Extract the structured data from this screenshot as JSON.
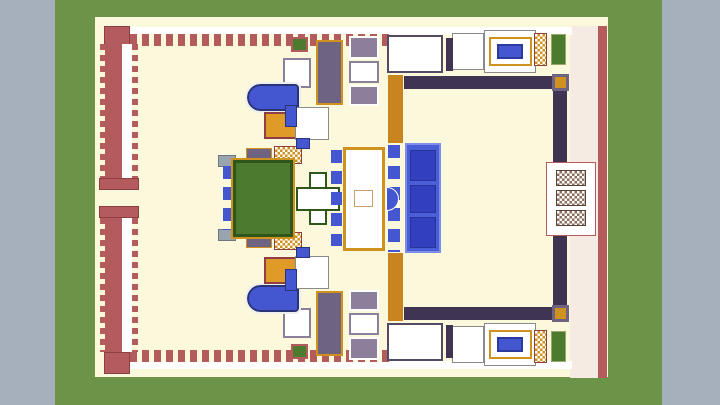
{
  "viewer": {
    "type": "3d-model-top-view",
    "subject": "minecraft-palace-build"
  },
  "palette": {
    "viewer_gray": "#a6b0bc",
    "grass_green": "#6b9448",
    "sand_cream": "#fbf8dc",
    "wall_red": "#b35b5d",
    "wall_dark_red": "#8e3f43",
    "gold": "#d0921e",
    "gold_light": "#ffd76e",
    "royal_blue": "#4456d0",
    "carpet_blue": "#4a5ed8",
    "carpet_panel_blue": "#3240c0",
    "purple_light": "#8b7f9b",
    "purple_dark": "#6e6380",
    "garden_green": "#4c7a2e",
    "garden_dark_green": "#2f571c",
    "tan": "#c9a06a",
    "navy": "#2b3a8c"
  },
  "scene": {
    "width": 720,
    "height": 405,
    "mirror_axis": 198,
    "blocks": [
      {
        "name": "viewer-background",
        "x": 0,
        "y": 0,
        "w": 720,
        "h": 405,
        "bg": "#a6b0bc"
      },
      {
        "name": "grass-ground",
        "x": 55,
        "y": 0,
        "w": 607,
        "h": 405,
        "bg": "#6b9448"
      },
      {
        "name": "sand-courtyard",
        "x": 95,
        "y": 17,
        "w": 513,
        "h": 360,
        "bg": "#fbf8dc"
      },
      {
        "name": "north-wall-checker-band",
        "x": 130,
        "y": 27,
        "w": 262,
        "h": 7,
        "bg": "#ffffff",
        "pattern": "checker",
        "c1": "#15151a",
        "c2": "#ffffff",
        "cs": "3px",
        "mirror": true
      },
      {
        "name": "north-wall-merlons",
        "x": 130,
        "y": 34,
        "w": 262,
        "h": 12,
        "pattern": "dash-h",
        "c1": "#b35b5d",
        "mirror": true
      },
      {
        "name": "northwest-corner-tower",
        "x": 104,
        "y": 26,
        "w": 26,
        "h": 22,
        "bg": "#b35b5d",
        "bc": "#8e3f43",
        "bw": 1
      },
      {
        "name": "southwest-corner-tower",
        "x": 104,
        "y": 352,
        "w": 26,
        "h": 22,
        "bg": "#b35b5d",
        "bc": "#8e3f43",
        "bw": 1
      },
      {
        "name": "west-wall-teeth-upper",
        "x": 100,
        "y": 44,
        "w": 5,
        "h": 134,
        "pattern": "dash-v",
        "c1": "#b35b5d"
      },
      {
        "name": "west-wall-upper",
        "x": 105,
        "y": 44,
        "w": 17,
        "h": 134,
        "bg": "#b35b5d"
      },
      {
        "name": "west-walkway-upper",
        "x": 122,
        "y": 44,
        "w": 10,
        "h": 134,
        "bg": "#ffffff"
      },
      {
        "name": "west-wall-dashes-upper",
        "x": 132,
        "y": 44,
        "w": 6,
        "h": 134,
        "pattern": "dash-v",
        "c1": "#b35b5d"
      },
      {
        "name": "west-gate-north-cap",
        "x": 99,
        "y": 178,
        "w": 40,
        "h": 12,
        "bg": "#b35b5d",
        "bc": "#8e3f43",
        "bw": 1
      },
      {
        "name": "west-gate-south-cap",
        "x": 99,
        "y": 206,
        "w": 40,
        "h": 12,
        "bg": "#b35b5d",
        "bc": "#8e3f43",
        "bw": 1
      },
      {
        "name": "west-wall-teeth-lower",
        "x": 100,
        "y": 218,
        "w": 5,
        "h": 134,
        "pattern": "dash-v",
        "c1": "#b35b5d"
      },
      {
        "name": "west-wall-lower",
        "x": 105,
        "y": 218,
        "w": 17,
        "h": 134,
        "bg": "#b35b5d"
      },
      {
        "name": "west-walkway-lower",
        "x": 122,
        "y": 218,
        "w": 10,
        "h": 134,
        "bg": "#ffffff"
      },
      {
        "name": "west-wall-dashes-lower",
        "x": 132,
        "y": 218,
        "w": 6,
        "h": 134,
        "pattern": "dash-v",
        "c1": "#b35b5d"
      },
      {
        "name": "east-wall-base",
        "x": 570,
        "y": 26,
        "w": 30,
        "h": 352,
        "bg": "#f6ebe2",
        "pattern": "dots",
        "c1": "#b35b5d",
        "cs": "5px"
      },
      {
        "name": "east-wall-edge",
        "x": 598,
        "y": 26,
        "w": 9,
        "h": 352,
        "bg": "#b35b5d",
        "pattern": "dash-v",
        "c1": "#ffffff"
      },
      {
        "name": "north-facade-trim",
        "x": 392,
        "y": 27,
        "w": 180,
        "h": 8,
        "bg": "#ffffff",
        "pattern": "dots",
        "c1": "#b35b5d",
        "cs": "4px",
        "mirror": true
      },
      {
        "name": "green-roof-patch",
        "x": 291,
        "y": 37,
        "w": 17,
        "h": 15,
        "bg": "#4c7a2e",
        "bc": "#b35b5d",
        "bw": 2,
        "mirror": true
      },
      {
        "name": "octagon-medallion-room",
        "x": 283,
        "y": 58,
        "w": 28,
        "h": 30,
        "bg": "#ffffff",
        "bc": "#8b7f9b",
        "bw": 2,
        "pattern": "target",
        "c1": "#6e6380",
        "c2": "#ffffff",
        "mirror": true
      },
      {
        "name": "purple-gallery",
        "x": 316,
        "y": 40,
        "w": 27,
        "h": 65,
        "bg": "#6e6380",
        "bc": "#d0921e",
        "bw": 2,
        "pattern": "two-diamonds",
        "c1": "#f2f0f6",
        "mirror": true
      },
      {
        "name": "mosaic-tile-north",
        "x": 349,
        "y": 36,
        "w": 30,
        "h": 23,
        "bg": "#8b7f9b",
        "bc": "#ffffff",
        "bw": 2,
        "pattern": "target",
        "c1": "#ffffff",
        "c2": "#6f9a4e",
        "mirror": true
      },
      {
        "name": "fountain-tile",
        "x": 349,
        "y": 61,
        "w": 30,
        "h": 22,
        "bg": "#ffffff",
        "bc": "#8b7f9b",
        "bw": 2,
        "pattern": "center-dot",
        "c1": "#4456d0",
        "mirror": true
      },
      {
        "name": "mosaic-tile-south",
        "x": 349,
        "y": 85,
        "w": 30,
        "h": 21,
        "bg": "#8b7f9b",
        "bc": "#ffffff",
        "bw": 2,
        "pattern": "target",
        "c1": "#ffffff",
        "c2": "#6f9a4e",
        "mirror": true
      },
      {
        "name": "pillared-hall",
        "x": 387,
        "y": 35,
        "w": 56,
        "h": 38,
        "bg": "#ffffff",
        "bc": "#544a63",
        "bw": 2,
        "mirror": true
      },
      {
        "name": "pillared-hall-mosaic",
        "x": 397,
        "y": 44,
        "w": 36,
        "h": 20,
        "bg": "#ffffff",
        "pattern": "dots",
        "c1": "#333333",
        "cs": "4px",
        "mirror": true
      },
      {
        "name": "gold-gallery-strip",
        "x": 388,
        "y": 75,
        "w": 15,
        "h": 68,
        "bg": "#c8851f",
        "pattern": "studs-v",
        "c1": "#7a5210",
        "c2": "#ffd76e",
        "mirror": true
      },
      {
        "name": "antechamber",
        "x": 452,
        "y": 33,
        "w": 32,
        "h": 37,
        "bg": "#ffffff",
        "bc": "#8a8a8a",
        "bw": 1,
        "mirror": true
      },
      {
        "name": "pavilion-stud-column",
        "x": 446,
        "y": 38,
        "w": 7,
        "h": 33,
        "bg": "#3f3552",
        "pattern": "tabs-sm",
        "c1": "#ffd76e",
        "mirror": true
      },
      {
        "name": "bath-pavilion",
        "x": 484,
        "y": 30,
        "w": 52,
        "h": 43,
        "bg": "#ffffff",
        "bc": "#8a8a8a",
        "bw": 1,
        "mirror": true
      },
      {
        "name": "bath-pavilion-colonnade",
        "x": 489,
        "y": 37,
        "w": 43,
        "h": 29,
        "bg": "#ffffff",
        "bc": "#d0921e",
        "bw": 2,
        "pattern": "dots",
        "c1": "#c9c2d4",
        "cs": "6px",
        "mirror": true
      },
      {
        "name": "bath-pool",
        "x": 497,
        "y": 44,
        "w": 26,
        "h": 15,
        "bg": "#4456d0",
        "bc": "#2a3a9e",
        "bw": 2,
        "pattern": "bubbles",
        "mirror": true
      },
      {
        "name": "gold-checker-tower",
        "x": 534,
        "y": 33,
        "w": 13,
        "h": 33,
        "pattern": "checker",
        "c1": "#d0921e",
        "c2": "#ffffff",
        "cs": "5px",
        "bc": "#8e3f43",
        "bw": 1,
        "mirror": true
      },
      {
        "name": "garden-bed-east",
        "x": 551,
        "y": 34,
        "w": 15,
        "h": 31,
        "bg": "#4c7a2e",
        "bc": "#9aa86e",
        "bw": 1,
        "mirror": true
      },
      {
        "name": "colonnade-north-row",
        "x": 404,
        "y": 76,
        "w": 150,
        "h": 13,
        "bg": "#3f3552",
        "pattern": "studs-h",
        "c1": "#e09a28",
        "c2": "#ffd76e",
        "mirror": true
      },
      {
        "name": "colonnade-north-corner",
        "x": 552,
        "y": 74,
        "w": 17,
        "h": 17,
        "bg": "#d0921e",
        "bc": "#6e6380",
        "bw": 3,
        "mirror": true
      },
      {
        "name": "colonnade-east-row",
        "x": 553,
        "y": 91,
        "w": 14,
        "h": 72,
        "bg": "#3f3552",
        "pattern": "studs-v",
        "c1": "#e09a28",
        "c2": "#ffd76e",
        "mirror": true
      },
      {
        "name": "east-gatehouse",
        "x": 546,
        "y": 162,
        "w": 50,
        "h": 74,
        "bg": "#ffffff",
        "bc": "#b35b5d",
        "bw": 1,
        "pattern": "dots",
        "c1": "#ecc8c0",
        "cs": "6px"
      },
      {
        "name": "east-gate-north",
        "x": 556,
        "y": 170,
        "w": 30,
        "h": 16,
        "pattern": "checker",
        "c1": "#8b6f5e",
        "c2": "#ffffff",
        "cs": "5px",
        "bc": "#5a4438",
        "bw": 1
      },
      {
        "name": "east-gate-middle",
        "x": 556,
        "y": 190,
        "w": 30,
        "h": 16,
        "pattern": "checker",
        "c1": "#8b6f5e",
        "c2": "#ffffff",
        "cs": "5px",
        "bc": "#5a4438",
        "bw": 1
      },
      {
        "name": "east-gate-south",
        "x": 556,
        "y": 210,
        "w": 30,
        "h": 16,
        "pattern": "checker",
        "c1": "#8b6f5e",
        "c2": "#ffffff",
        "cs": "5px",
        "bc": "#5a4438",
        "bw": 1
      },
      {
        "name": "round-pool",
        "x": 247,
        "y": 84,
        "w": 52,
        "h": 27,
        "bg": "#4456d0",
        "bc": "#2a3577",
        "bw": 2,
        "radius": "14px 4px 4px 14px",
        "outline": "2px solid #eeeeee",
        "pattern": "bubbles",
        "mirror": true
      },
      {
        "name": "arched-chamber",
        "x": 264,
        "y": 112,
        "w": 36,
        "h": 27,
        "bg": "#e09a28",
        "bc": "#8e3f43",
        "bw": 2,
        "pattern": "arch",
        "c1": "#ffffff",
        "mirror": true
      },
      {
        "name": "fountain-court",
        "x": 295,
        "y": 107,
        "w": 34,
        "h": 33,
        "bg": "#ffffff",
        "bc": "#8a8a8a",
        "bw": 1,
        "pattern": "dots",
        "c1": "#4456d0",
        "cs": "8px",
        "dr": "2px",
        "mirror": true
      },
      {
        "name": "blue-cistern",
        "x": 285,
        "y": 105,
        "w": 12,
        "h": 22,
        "bg": "#4456d0",
        "bc": "#2a3577",
        "bw": 1,
        "mirror": true
      },
      {
        "name": "service-block",
        "x": 218,
        "y": 155,
        "w": 18,
        "h": 12,
        "bg": "#9aa4ae",
        "bc": "#6e7680",
        "bw": 1,
        "mirror": true
      },
      {
        "name": "oval-medallion-tile",
        "x": 246,
        "y": 148,
        "w": 26,
        "h": 20,
        "bg": "#6e6380",
        "bc": "#d0921e",
        "bw": 1,
        "pattern": "oval",
        "c1": "#ffffff",
        "mirror": true
      },
      {
        "name": "gold-checker-tile",
        "x": 274,
        "y": 146,
        "w": 28,
        "h": 18,
        "pattern": "checker",
        "c1": "#d0921e",
        "c2": "#ffffff",
        "cs": "5px",
        "bc": "#8e3f43",
        "bw": 1,
        "mirror": true
      },
      {
        "name": "garden-west-pillars",
        "x": 223,
        "y": 166,
        "w": 12,
        "h": 64,
        "pattern": "tabs-v",
        "c1": "#4456d0"
      },
      {
        "name": "sunken-garden",
        "x": 233,
        "y": 160,
        "w": 60,
        "h": 77,
        "bg": "#4c7a2e",
        "bc": "#2f571c",
        "bw": 3,
        "outline": "2px solid #d0921e",
        "pattern": "three-circles",
        "c1": "#f4f0e0"
      },
      {
        "name": "plaza-cross-vertical",
        "x": 309,
        "y": 172,
        "w": 18,
        "h": 53,
        "bg": "#ffffff",
        "bc": "#2f571c",
        "bw": 2,
        "pattern": "dots",
        "c1": "#4c7a2e",
        "cs": "9px",
        "dr": "2.2px"
      },
      {
        "name": "plaza-cross-horizontal",
        "x": 296,
        "y": 187,
        "w": 44,
        "h": 24,
        "bg": "#ffffff",
        "bc": "#2f571c",
        "bw": 2,
        "pattern": "dots",
        "c1": "#4c7a2e",
        "cs": "9px",
        "dr": "2.2px"
      },
      {
        "name": "plaza-blue-tab",
        "x": 296,
        "y": 138,
        "w": 14,
        "h": 11,
        "bg": "#4456d0",
        "bc": "#2a3577",
        "bw": 1,
        "mirror": true
      },
      {
        "name": "audience-hall",
        "x": 343,
        "y": 147,
        "w": 42,
        "h": 104,
        "bg": "#ffffff",
        "bc": "#d0921e",
        "bw": 3,
        "pattern": "hall-floor",
        "c1": "#2b3a8c",
        "c2": "#c9a06a"
      },
      {
        "name": "audience-hall-dais",
        "x": 354,
        "y": 190,
        "w": 19,
        "h": 17,
        "bg": "#ffffff",
        "bc": "#c9a06a",
        "bw": 1,
        "pattern": "center-dot",
        "c1": "#4456d0"
      },
      {
        "name": "pillar-row-west",
        "x": 331,
        "y": 150,
        "w": 11,
        "h": 96,
        "pattern": "tabs-v",
        "c1": "#4456d0"
      },
      {
        "name": "pillar-row-east",
        "x": 388,
        "y": 145,
        "w": 12,
        "h": 107,
        "pattern": "tabs-v",
        "c1": "#4456d0"
      },
      {
        "name": "apse-niche",
        "x": 386,
        "y": 187,
        "w": 13,
        "h": 24,
        "bg": "#4456d0",
        "bc": "#ffffff",
        "bw": 1,
        "radius": "0 12px 12px 0"
      },
      {
        "name": "grand-blue-carpet",
        "x": 405,
        "y": 143,
        "w": 36,
        "h": 110,
        "bg": "#4a5ed8",
        "bc": "#7e8ee8",
        "bw": 2
      },
      {
        "name": "carpet-panel-north",
        "x": 410,
        "y": 150,
        "w": 26,
        "h": 31,
        "bg": "#3240c0",
        "bc": "#27349b",
        "bw": 1,
        "pattern": "target",
        "c1": "#5a6ae0",
        "c2": "#3240c0"
      },
      {
        "name": "carpet-panel-middle",
        "x": 410,
        "y": 185,
        "w": 26,
        "h": 28,
        "bg": "#3240c0",
        "bc": "#27349b",
        "bw": 1,
        "pattern": "target",
        "c1": "#5a6ae0",
        "c2": "#3240c0"
      },
      {
        "name": "carpet-panel-south",
        "x": 410,
        "y": 217,
        "w": 26,
        "h": 31,
        "bg": "#3240c0",
        "bc": "#27349b",
        "bw": 1,
        "pattern": "target",
        "c1": "#5a6ae0",
        "c2": "#3240c0"
      }
    ]
  }
}
